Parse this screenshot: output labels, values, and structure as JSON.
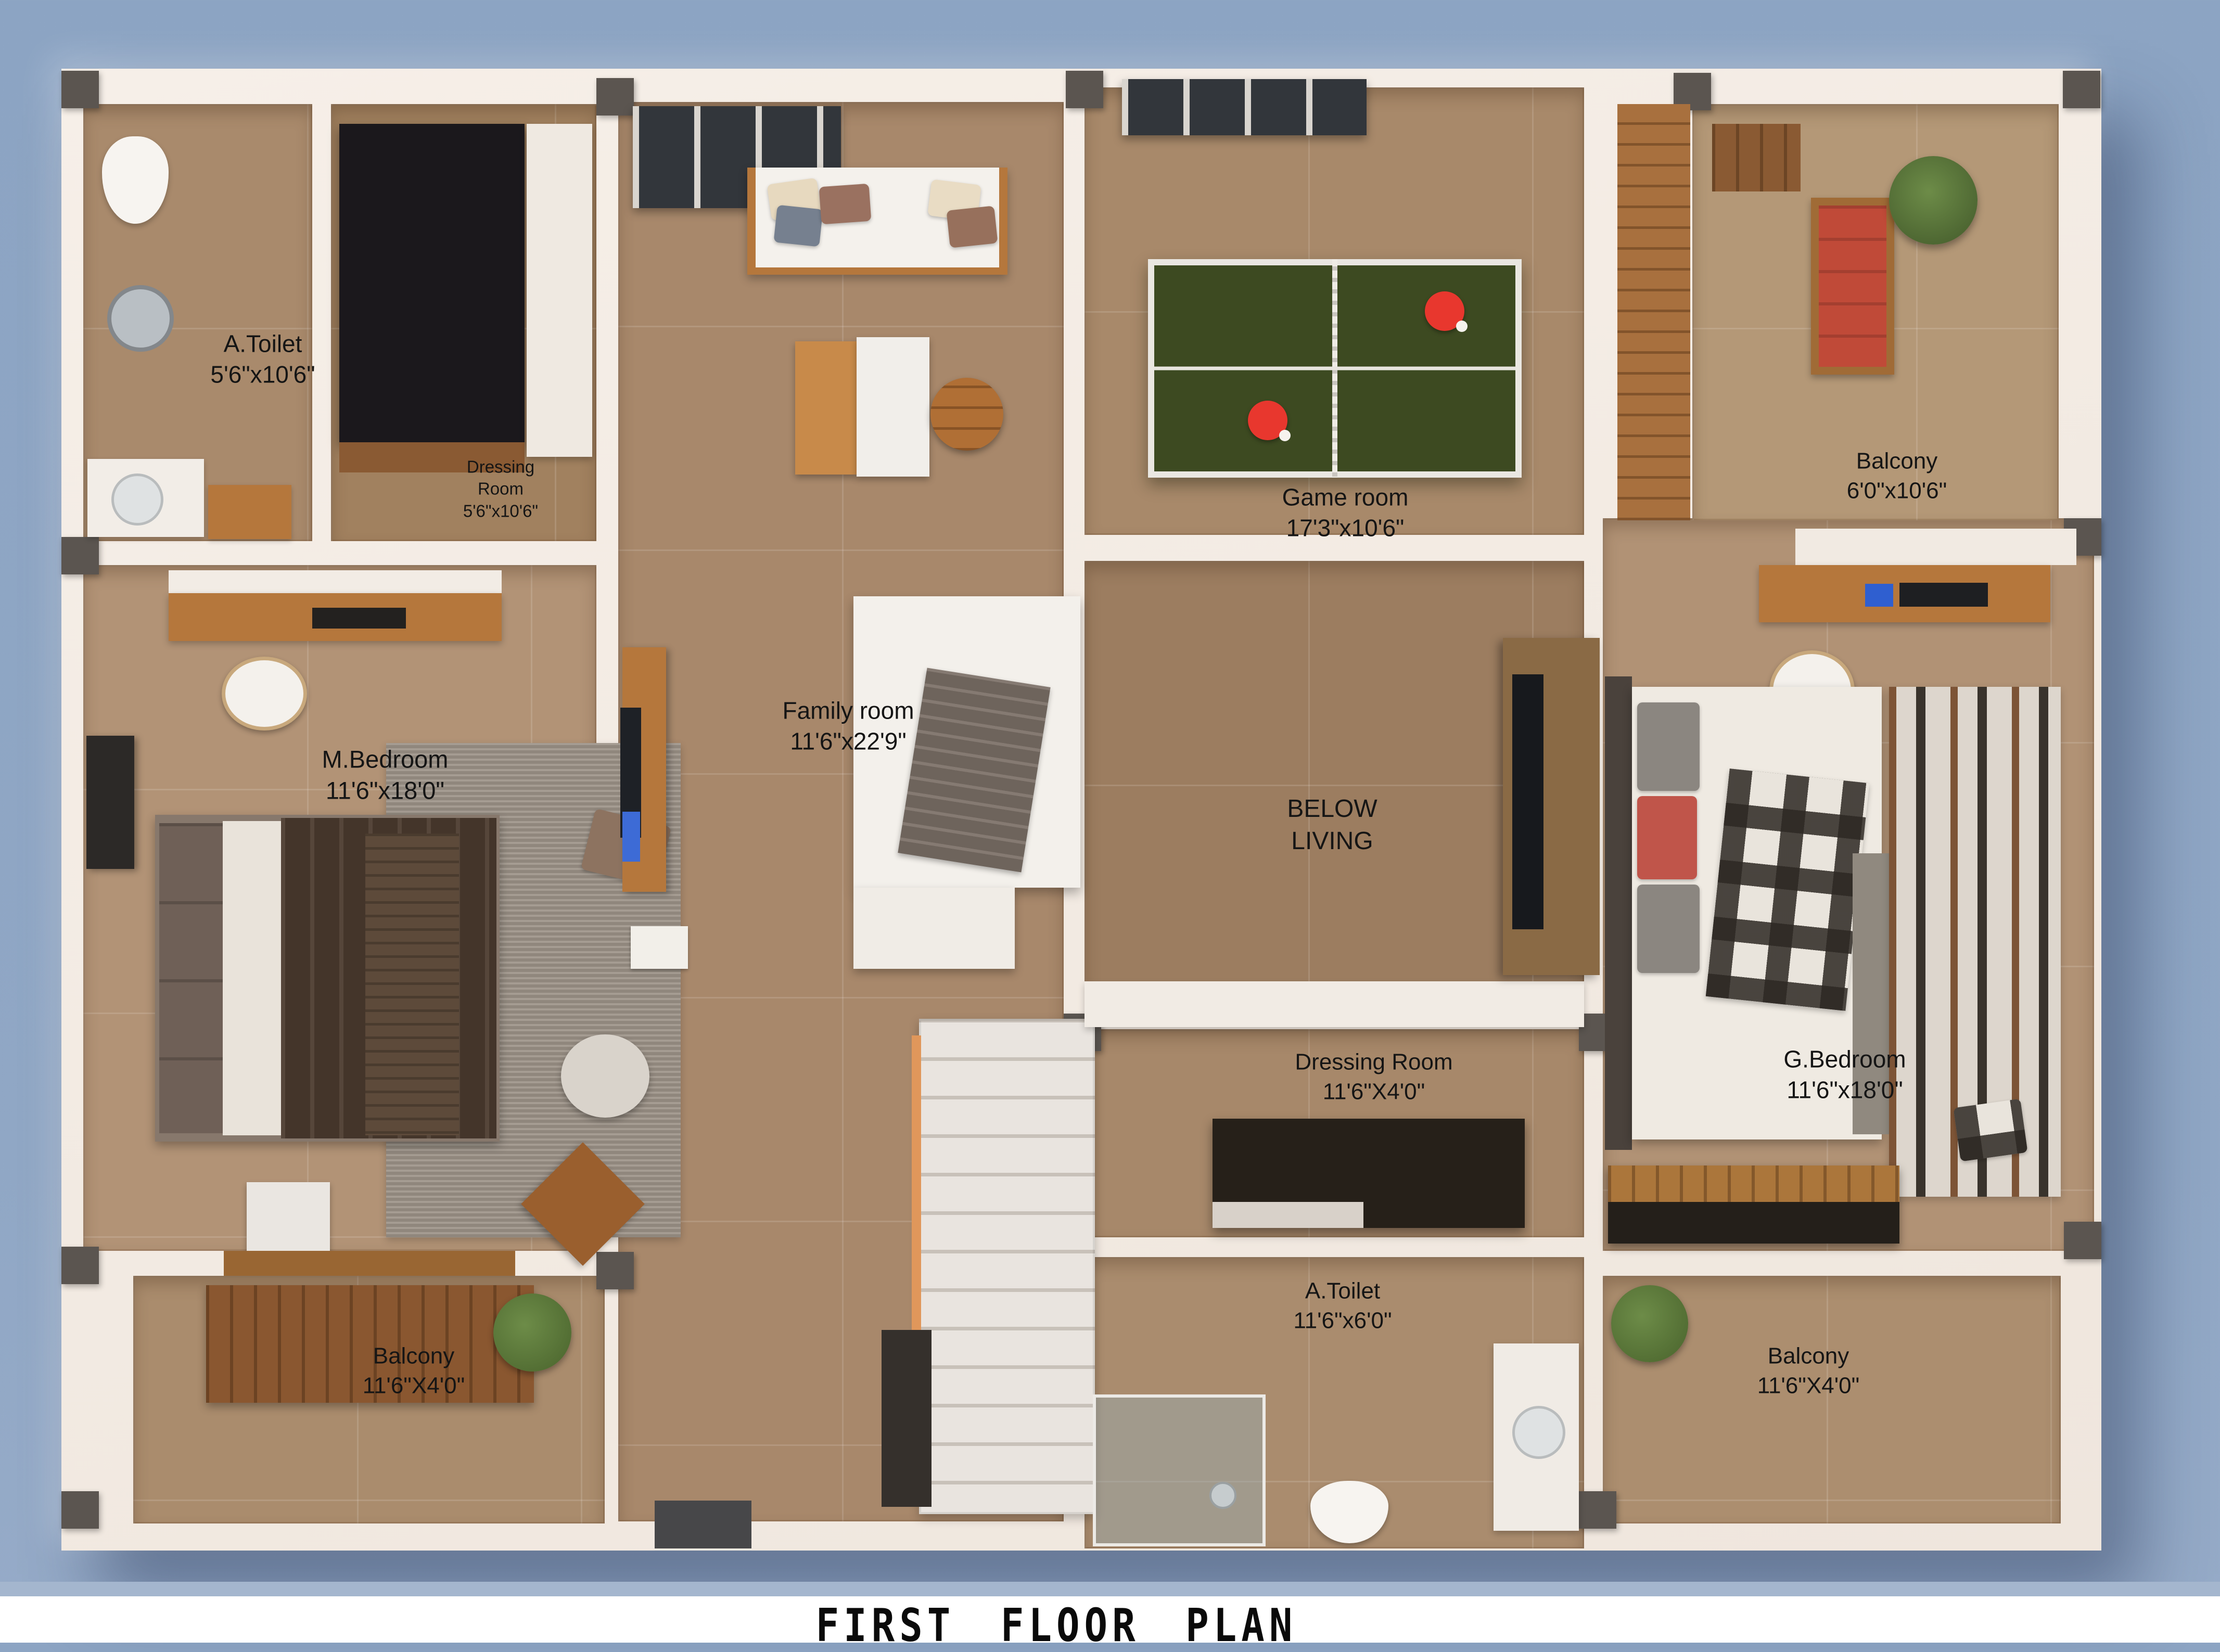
{
  "title": "FIRST FLOOR PLAN",
  "colors": {
    "sky_background": "#8ca4c3",
    "wall_white": "#f3ece5",
    "floor_tan": "#a8886b",
    "ping_pong_green": "#3d4a21",
    "paddle_red": "#e8372e",
    "wood_accent": "#b5773c"
  },
  "rooms": {
    "toilet_tl": {
      "name": "A.Toilet",
      "dims": "5'6\"x10'6\""
    },
    "dressing_tl": {
      "name": "Dressing\nRoom",
      "dims": "5'6\"x10'6\""
    },
    "m_bedroom": {
      "name": "M.Bedroom",
      "dims": "11'6\"x18'0\""
    },
    "family": {
      "name": "Family room",
      "dims": "11'6\"x22'9\""
    },
    "game": {
      "name": "Game room",
      "dims": "17'3\"x10'6\""
    },
    "below_living": {
      "name": "BELOW\nLIVING"
    },
    "balcony_tr": {
      "name": "Balcony",
      "dims": "6'0\"x10'6\""
    },
    "dressing_c": {
      "name": "Dressing Room",
      "dims": "11'6\"X4'0\""
    },
    "g_bedroom": {
      "name": "G.Bedroom",
      "dims": "11'6\"x18'0\""
    },
    "toilet_c": {
      "name": "A.Toilet",
      "dims": "11'6\"x6'0\""
    },
    "balcony_bl": {
      "name": "Balcony",
      "dims": "11'6\"X4'0\""
    },
    "balcony_br": {
      "name": "Balcony",
      "dims": "11'6\"X4'0\""
    }
  }
}
